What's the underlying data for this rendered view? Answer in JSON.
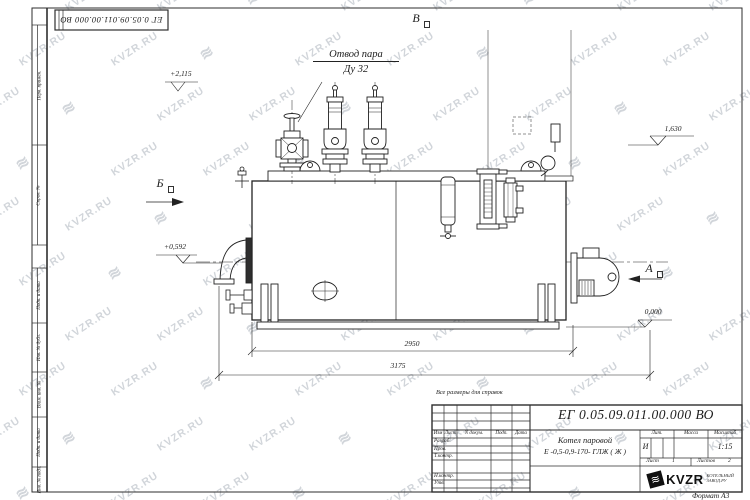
{
  "watermark": {
    "text": "KVZR.RU",
    "logo_glyph": "≋"
  },
  "corner_stamp": {
    "text": "ЕГ 0.05.09.011.00.000  ВО"
  },
  "margin_labels": [
    "Перв. примен.",
    "Справ. №",
    "Подп. и дата",
    "Инв. № дубл.",
    "Взам. инв. №",
    "Подп. и дата",
    "Инв. № подл."
  ],
  "drawing": {
    "callout_line1": "Отвод пара",
    "callout_line2": "Ду 32",
    "levels": {
      "top": "+2,115",
      "right_upper": "1,630",
      "left_mid": "+0,592",
      "ground": "0,000"
    },
    "view_labels": {
      "top": "В",
      "left": "Б",
      "right": "А"
    },
    "dimensions": {
      "inner": "2950",
      "overall": "3175"
    }
  },
  "note": "Все размеры для справок",
  "title_block": {
    "designation": "ЕГ 0.05.09.011.00.000  ВО",
    "product_name_line1": "Котел паровой",
    "product_name_line2": "Е -0,5-0,9-170- ГЛЖ ( Ж )",
    "col_izm": "Изм",
    "col_list": "Лист",
    "col_ndoc": "N докум.",
    "col_podp": "Подп.",
    "col_data": "Дата",
    "row_labels": [
      "Разраб.",
      "Пров.",
      "Т.контр.",
      "Н.контр.",
      "Утв."
    ],
    "lit_label": "Лит.",
    "lit_value": "И",
    "mass_label": "Масса",
    "scale_label": "Масштаб",
    "scale_value": "1:15",
    "sheet_label": "Лист",
    "sheet_value": "1",
    "sheets_label": "Листов",
    "sheets_value": "2",
    "company_logo_text": "KVZR",
    "company_sub_line1": "КОТЕЛЬНЫЙ",
    "company_sub_line2": "ЗАВОД.РУ",
    "format_label": "Формат А3"
  }
}
